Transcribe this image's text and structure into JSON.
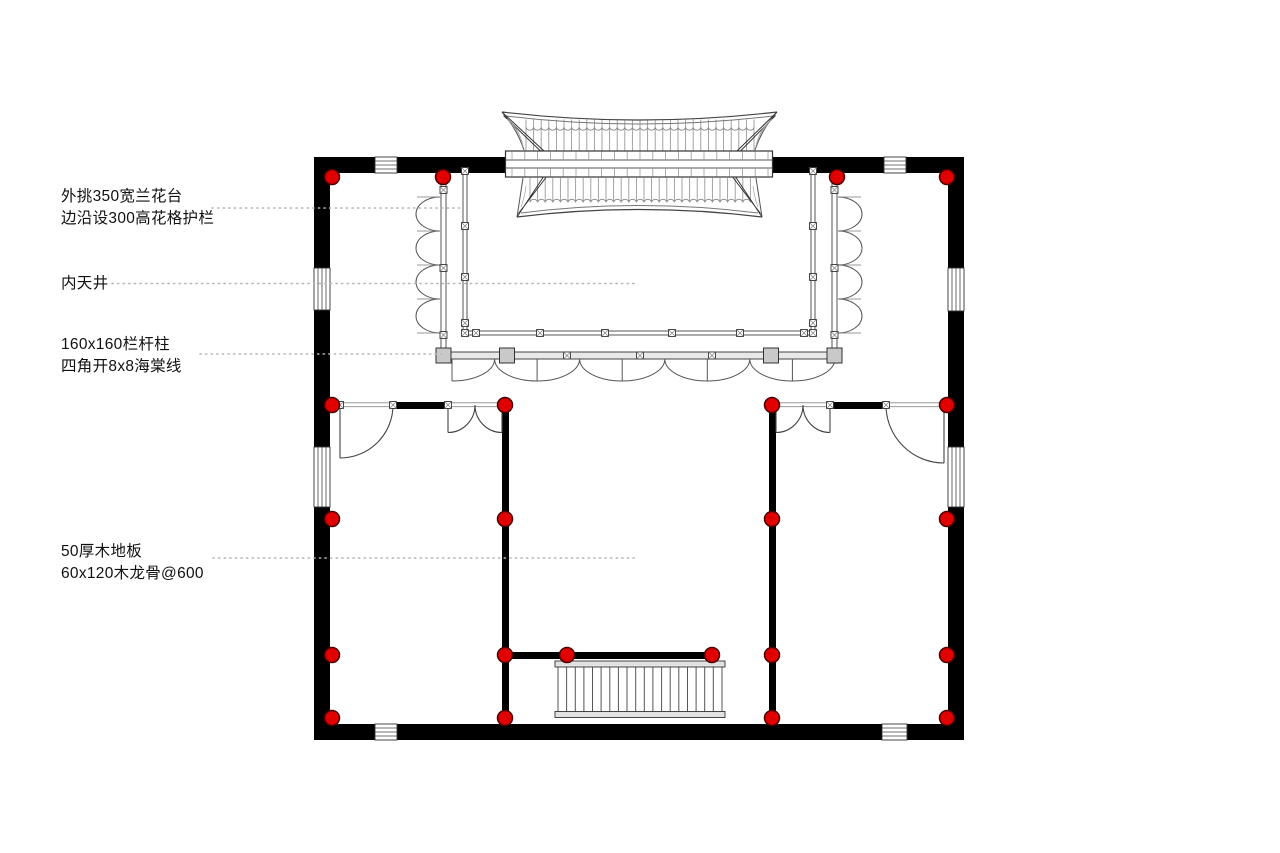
{
  "drawing": {
    "background": "#ffffff",
    "annotations": [
      {
        "id": "planter",
        "lines": [
          "外挑350宽兰花台",
          "边沿设300高花格护栏"
        ]
      },
      {
        "id": "courtyard",
        "lines": [
          "内天井"
        ]
      },
      {
        "id": "railing_post",
        "lines": [
          "160x160栏杆柱",
          "四角开8x8海棠线"
        ]
      },
      {
        "id": "wood_floor",
        "lines": [
          "50厚木地板",
          "60x120木龙骨@600"
        ]
      }
    ],
    "colors": {
      "wall": "#000000",
      "column_marker": "#e10000",
      "column_marker_outline": "#4a0000",
      "line": "#555555",
      "door_line": "#444444",
      "roof_line": "#888888",
      "leader": "#b5b5b5",
      "beam_fill": "#e8e8e8",
      "post_fill": "#c9c9c9",
      "stair_fill": "#e2e2e2",
      "window_line": "#444444"
    },
    "column_markers": {
      "radius": 7.5,
      "positions": [
        [
          332,
          177
        ],
        [
          443,
          177
        ],
        [
          837,
          177
        ],
        [
          947,
          177
        ],
        [
          332,
          405
        ],
        [
          505,
          405
        ],
        [
          772,
          405
        ],
        [
          947,
          405
        ],
        [
          332,
          519
        ],
        [
          505,
          519
        ],
        [
          772,
          519
        ],
        [
          947,
          519
        ],
        [
          332,
          655
        ],
        [
          505,
          655
        ],
        [
          567,
          655
        ],
        [
          712,
          655
        ],
        [
          772,
          655
        ],
        [
          947,
          655
        ],
        [
          332,
          718
        ],
        [
          505,
          718
        ],
        [
          772,
          718
        ],
        [
          947,
          718
        ]
      ]
    }
  }
}
